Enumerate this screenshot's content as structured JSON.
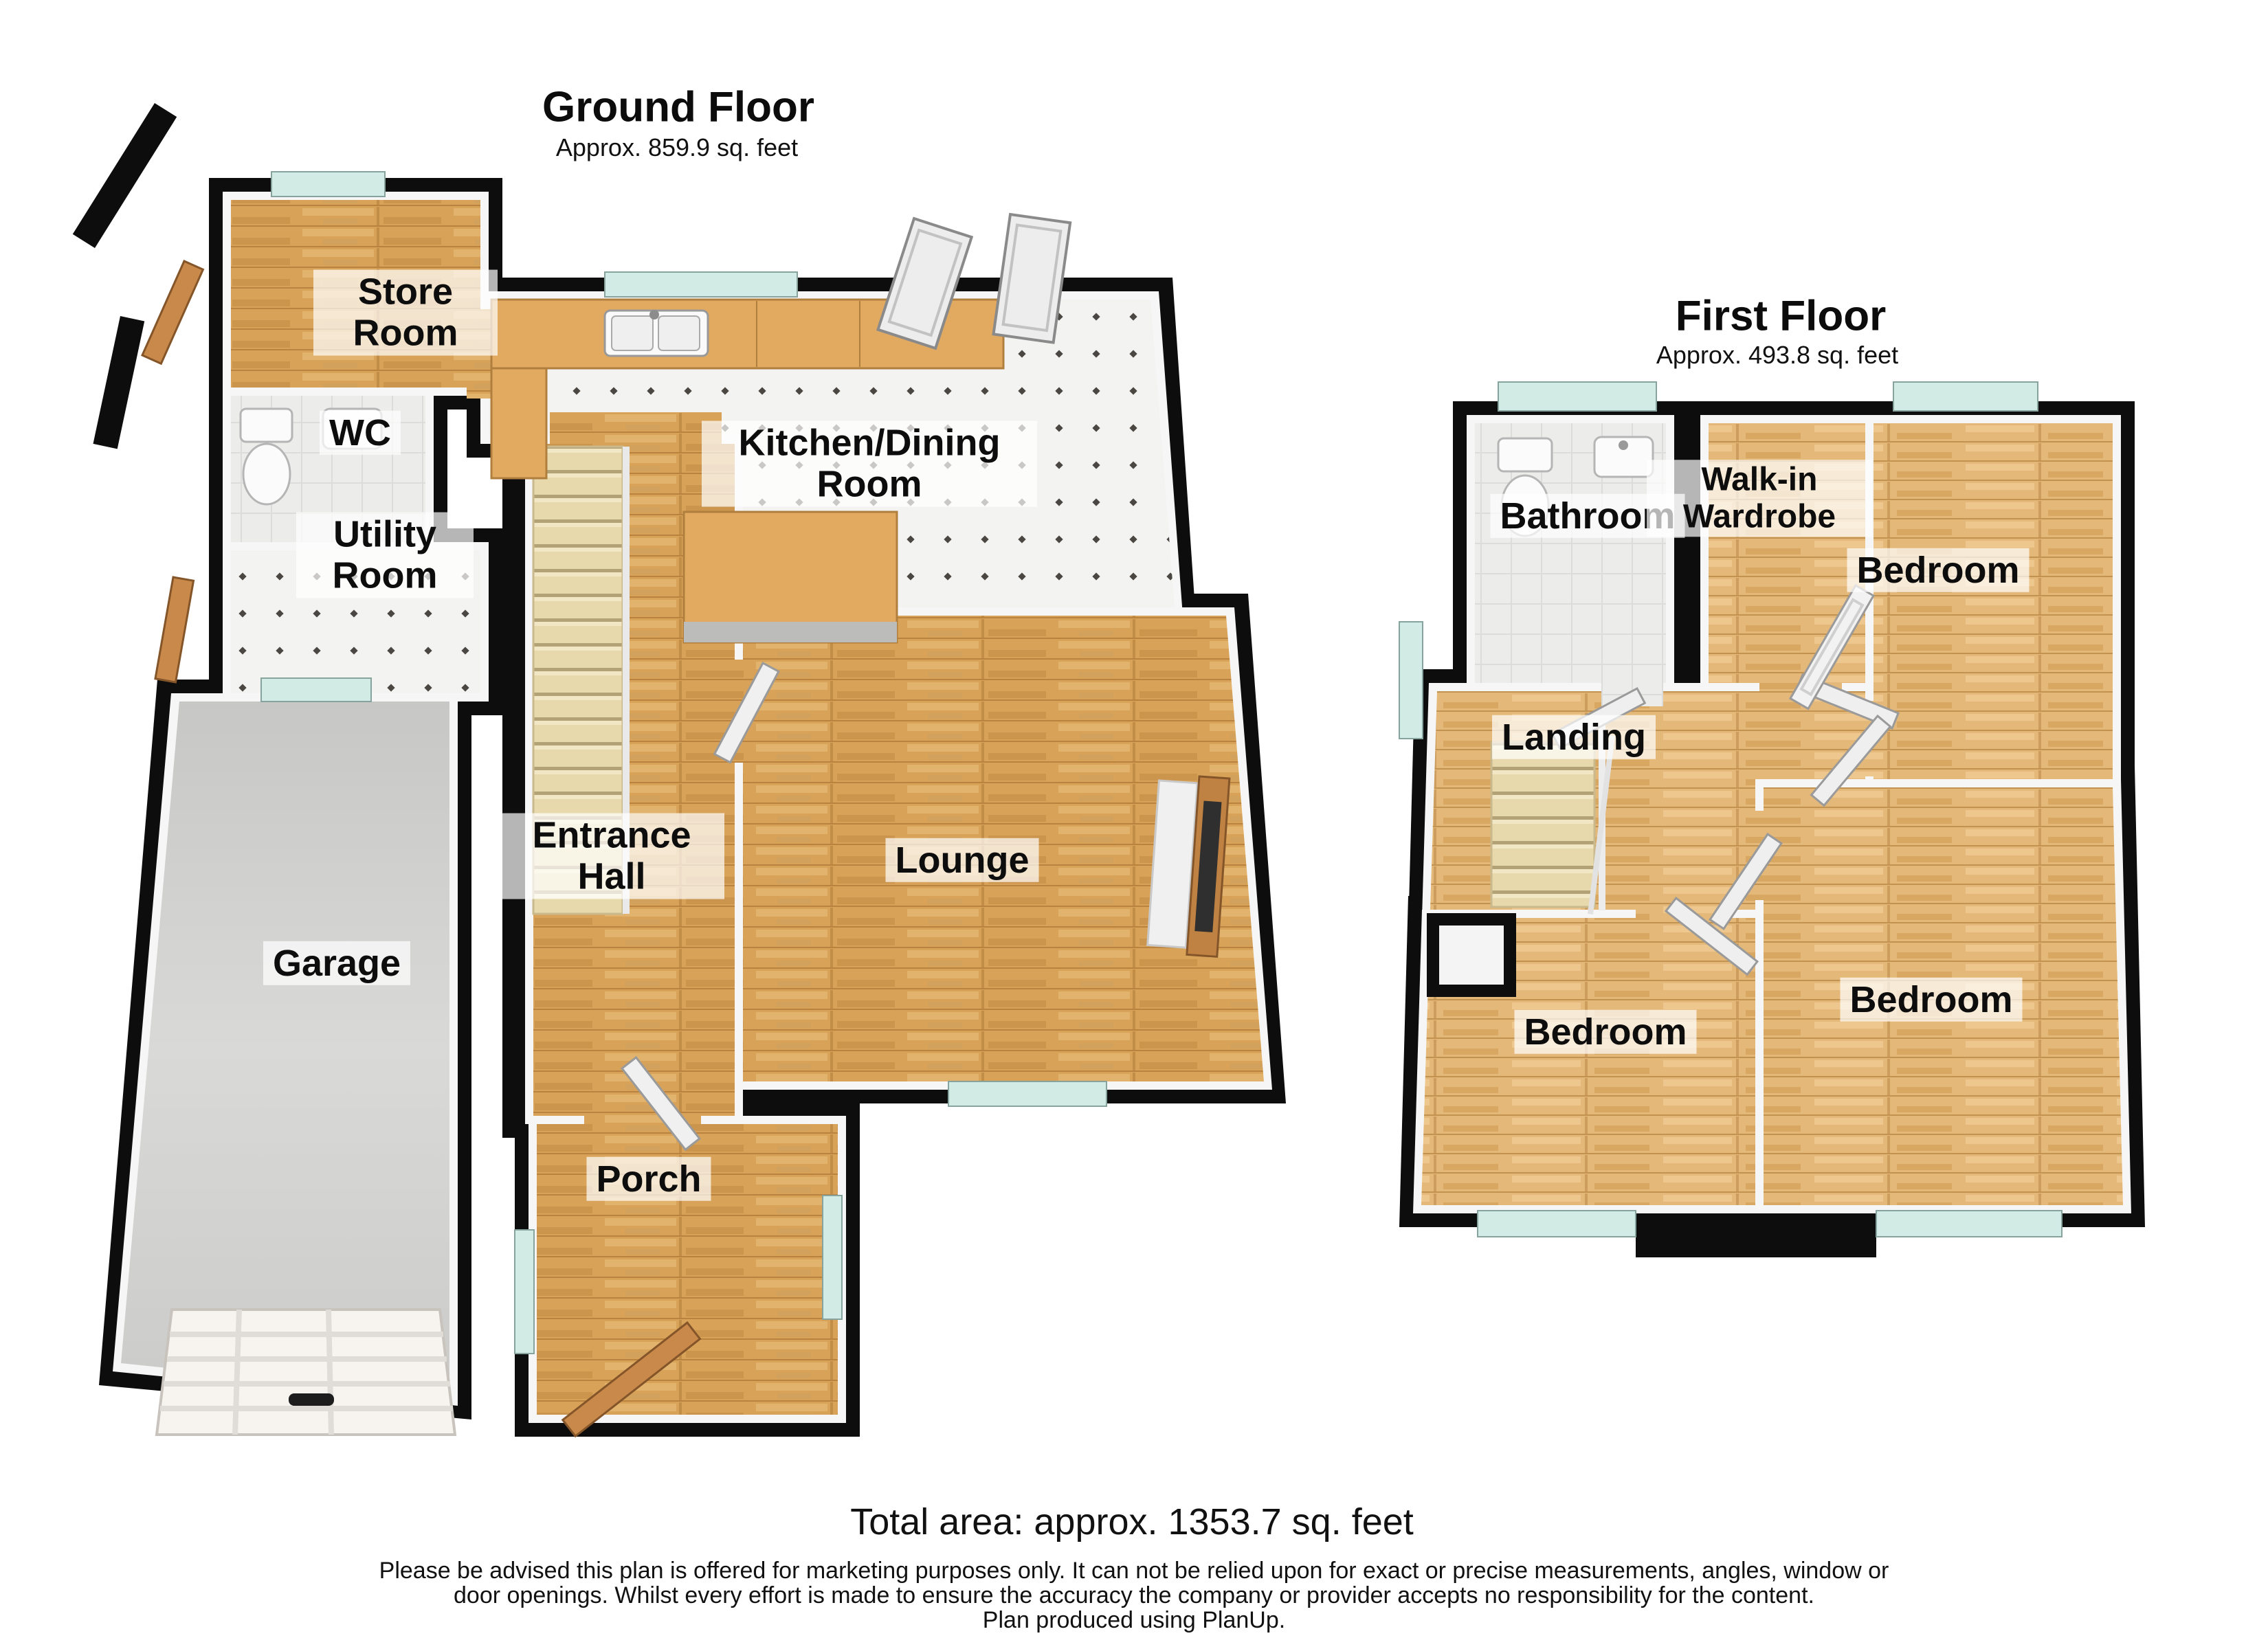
{
  "ground_floor": {
    "title": "Ground Floor",
    "area": "Approx. 859.9 sq. feet",
    "rooms": [
      {
        "label": "Store Room"
      },
      {
        "label": "WC"
      },
      {
        "label": "Utility Room"
      },
      {
        "label": "Kitchen/Dining Room"
      },
      {
        "label": "Entrance Hall"
      },
      {
        "label": "Lounge"
      },
      {
        "label": "Garage"
      },
      {
        "label": "Porch"
      }
    ]
  },
  "first_floor": {
    "title": "First Floor",
    "area": "Approx. 493.8 sq. feet",
    "rooms": [
      {
        "label": "Bathroom"
      },
      {
        "label": "Walk-in Wardrobe"
      },
      {
        "label": "Bedroom"
      },
      {
        "label": "Landing"
      },
      {
        "label": "Bedroom"
      },
      {
        "label": "Bedroom"
      }
    ]
  },
  "footer": {
    "total_area": "Total area: approx. 1353.7 sq. feet",
    "disclaimer_line1": "Please be advised this plan is offered for marketing purposes only. It can not be relied upon for exact or precise measurements, angles, window or",
    "disclaimer_line2": "door openings. Whilst every effort is made to ensure the accuracy the company or provider accepts no responsibility for the content.",
    "disclaimer_line3": "Plan produced using PlanUp."
  },
  "palette": {
    "wall": "#0d0d0d",
    "inner_wall": "#f6f6f6",
    "window_glass": "#d3ebe5",
    "wood_floor_ground": "#d8a359",
    "wood_floor_first": "#e4b878",
    "kitchen_tile": "#f3f3f1",
    "garage_floor": "#cfcfcd",
    "stairs": "#e8d9ac",
    "counter_wood": "#e2aa61",
    "door_wood": "#c8894a",
    "label_background": "#ffffff"
  }
}
